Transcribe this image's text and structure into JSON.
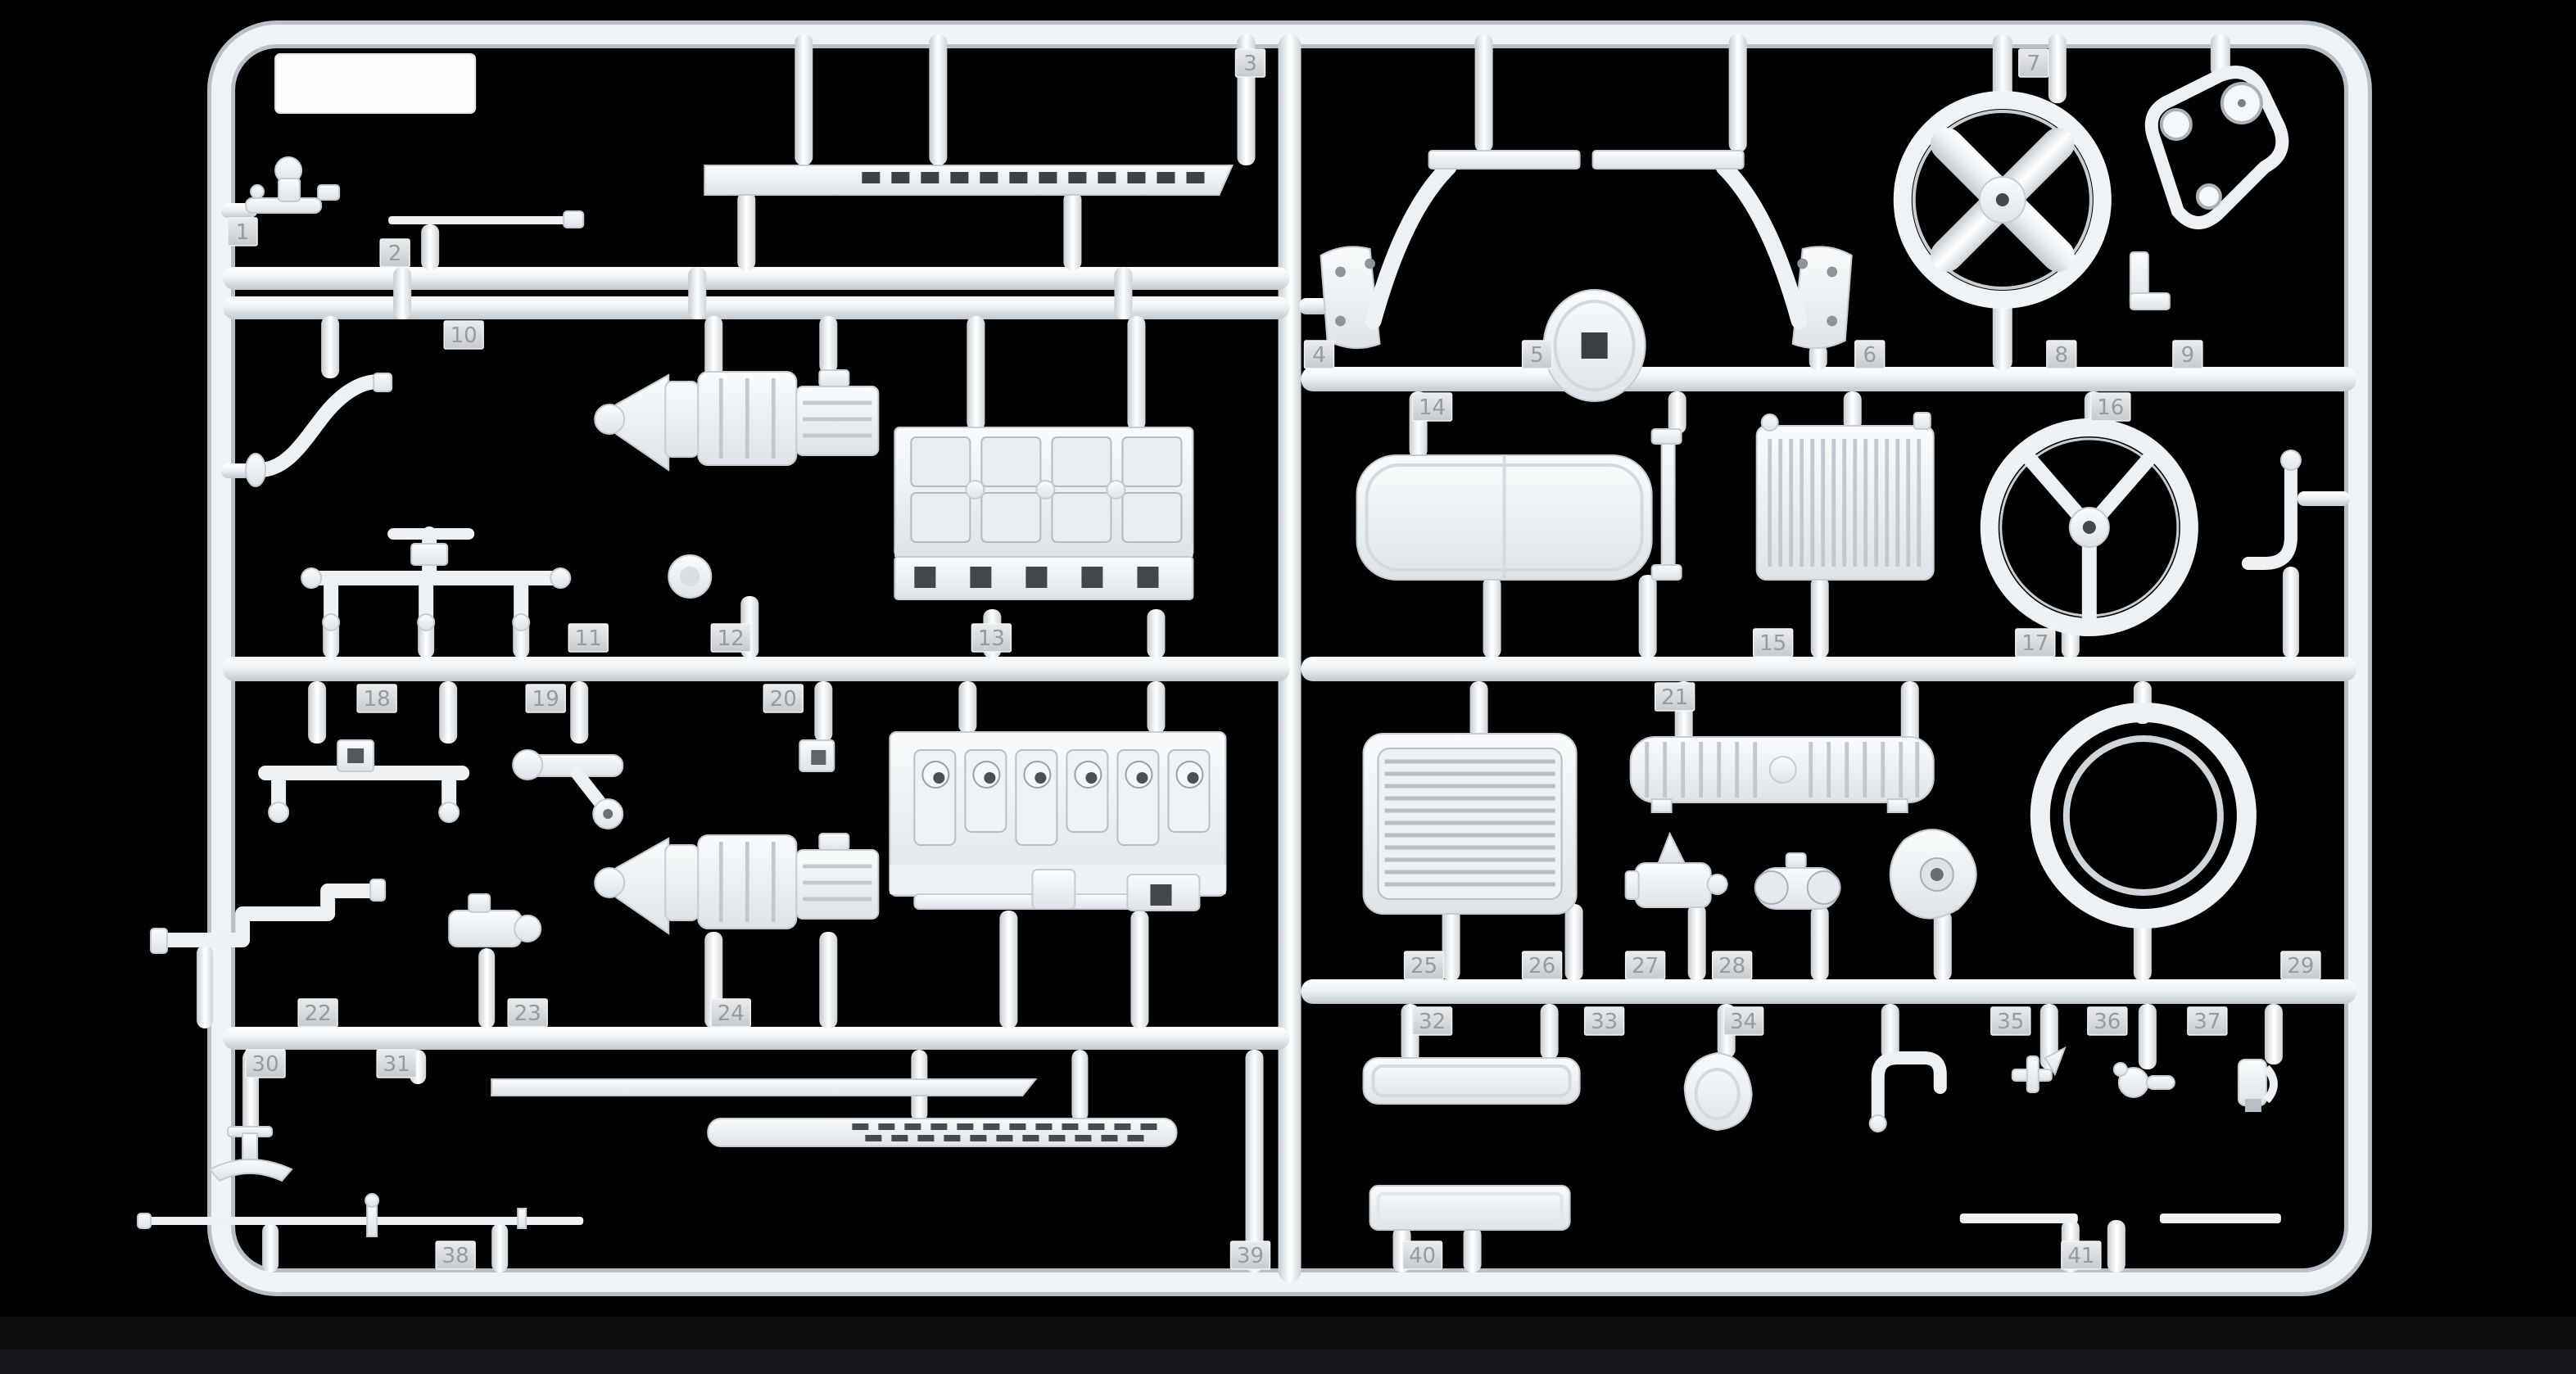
{
  "scene": {
    "subject": "Injection-molded model kit sprue photographed on a black background",
    "material": "white styrene plastic",
    "panel_count": 2,
    "part_tag_total": 41,
    "colors": {
      "background": "#000000",
      "plastic": "#f1f4f6",
      "plastic_shadow": "#c6ccd2",
      "tag_face": "#d9dbde",
      "tag_digit": "#969ba1",
      "bottom_band": "#121316"
    }
  },
  "parts": [
    {
      "number": "1",
      "name": "valve fitting"
    },
    {
      "number": "2",
      "name": "tie rod"
    },
    {
      "number": "3",
      "name": "slotted strip"
    },
    {
      "number": "4",
      "name": "mirrored frame braces with mounting plates"
    },
    {
      "number": "5",
      "name": "disc with square hub hole"
    },
    {
      "number": "6",
      "name": "cooling fan"
    },
    {
      "number": "7",
      "name": "top runner fitting"
    },
    {
      "number": "8",
      "name": "angle bracket"
    },
    {
      "number": "9",
      "name": "belt and pulley loop"
    },
    {
      "number": "10",
      "name": "exhaust header pipe"
    },
    {
      "number": "11",
      "name": "pipe manifold"
    },
    {
      "number": "12",
      "name": "round cap"
    },
    {
      "number": "13",
      "name": "engine block, top half"
    },
    {
      "number": "14",
      "name": "fuel tank"
    },
    {
      "number": "15",
      "name": "radiator"
    },
    {
      "number": "16",
      "name": "steering wheel"
    },
    {
      "number": "17",
      "name": "J-hook bracket"
    },
    {
      "number": "18",
      "name": "axle bracket"
    },
    {
      "number": "19",
      "name": "link with lever arm"
    },
    {
      "number": "20",
      "name": "square fitting"
    },
    {
      "number": "21",
      "name": "ribbed cylindrical tank"
    },
    {
      "number": "22",
      "name": "stepped elbow pipe"
    },
    {
      "number": "23",
      "name": "pump body"
    },
    {
      "number": "24",
      "name": "transmission"
    },
    {
      "number": "25",
      "name": "radiator core"
    },
    {
      "number": "26",
      "name": "cylinder with filler cap"
    },
    {
      "number": "27",
      "name": "small cylinder"
    },
    {
      "number": "28",
      "name": "teardrop housing"
    },
    {
      "number": "29",
      "name": "tire ring"
    },
    {
      "number": "30",
      "name": "pedestal stand"
    },
    {
      "number": "31",
      "name": "flat strip"
    },
    {
      "number": "32",
      "name": "cover plate"
    },
    {
      "number": "33",
      "name": "seat pan"
    },
    {
      "number": "34",
      "name": "grab handle"
    },
    {
      "number": "35",
      "name": "small bracket"
    },
    {
      "number": "36",
      "name": "knob fitting"
    },
    {
      "number": "37",
      "name": "flanged fitting"
    },
    {
      "number": "38",
      "name": "long rod"
    },
    {
      "number": "39",
      "name": "slotted muffler"
    },
    {
      "number": "40",
      "name": "base plate"
    },
    {
      "number": "41",
      "name": "thin strip pair"
    }
  ]
}
